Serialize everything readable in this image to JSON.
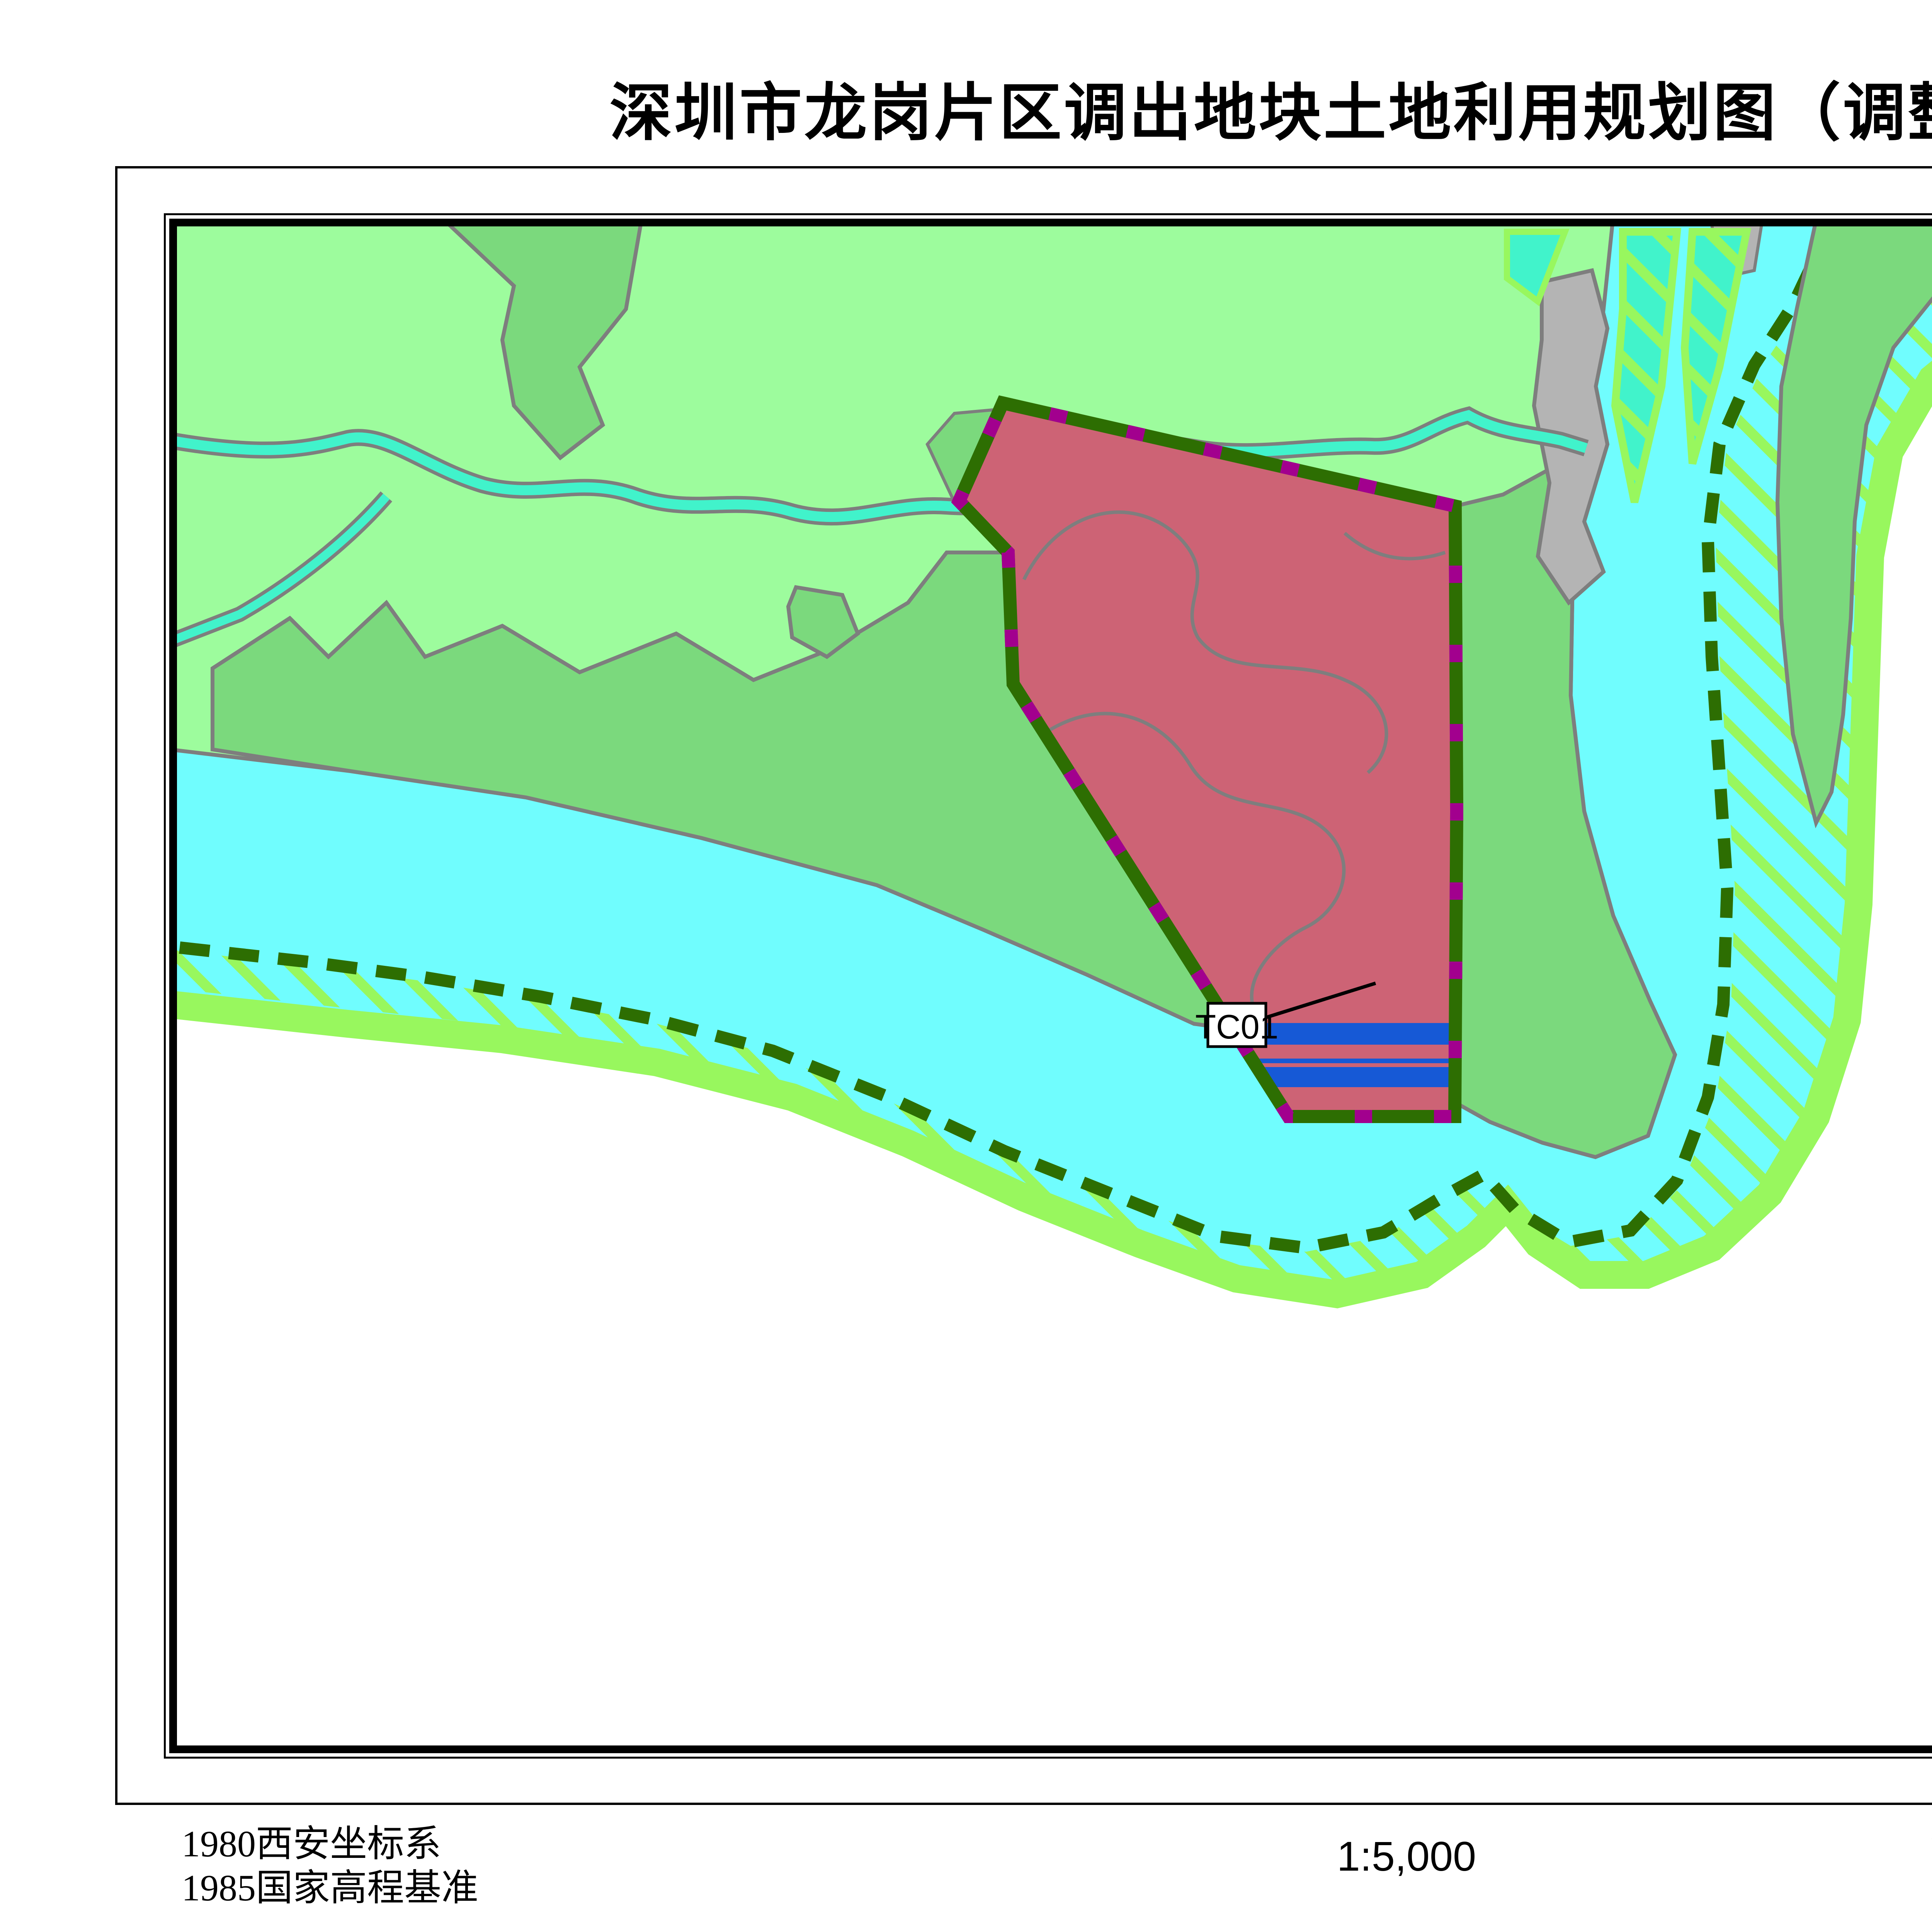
{
  "title": "深圳市龙岗片区调出地块土地利用规划图（调整前）",
  "north_label": "N",
  "map": {
    "plot_label": "TC01",
    "colors": {
      "water": "#70fdfe",
      "river": "#41f3cb",
      "orchard": "#9dfc9d",
      "forest": "#7bd97d",
      "urban": "#cd6375",
      "shore_band": "#98f75e",
      "forbidden_line": "#2d6e02",
      "allowed_line": "#a2008e",
      "plot_blue": "#1659d6",
      "reserved_gray": "#b4b4b4",
      "outline_gray": "#7e7e7e"
    }
  },
  "legend": {
    "title": "图例",
    "items": [
      {
        "label": "调出地块",
        "swatch": "outline",
        "color": "#1456d8"
      },
      {
        "label": "允许建设区",
        "swatch": "outline",
        "color": "#a3009b"
      },
      {
        "label": "有条件建设区",
        "swatch": "hatch-outline",
        "color": "#a3009b",
        "hatch": "#dd6666"
      },
      {
        "label": "禁止建设区",
        "swatch": "dashed-outline",
        "color": "#2f7009"
      },
      {
        "label": "限制建设区",
        "swatch": "hatch-outline",
        "color": "#98f75e",
        "hatch": "#98f75e"
      },
      {
        "label": "基本农田保护区",
        "swatch": "outline-fill",
        "color": "#88a903",
        "fill": "#f7f73d"
      },
      {
        "label": "耕地",
        "swatch": "fill",
        "fill": "#eff59b"
      },
      {
        "label": "园地",
        "swatch": "fill",
        "fill": "#9dfc9d"
      },
      {
        "label": "林地",
        "swatch": "fill",
        "fill": "#74d678"
      },
      {
        "label": "其他农用地",
        "swatch": "fill",
        "fill": "#41f3cb"
      },
      {
        "label": "城乡建设用地",
        "swatch": "fill",
        "fill": "#c5607a"
      },
      {
        "label": "交通水利用地",
        "swatch": "fill",
        "fill": "#f79437"
      },
      {
        "label": "其他建设用地",
        "swatch": "fill",
        "fill": "#d2671e"
      },
      {
        "label": "水域",
        "swatch": "fill",
        "fill": "#70fdfe"
      },
      {
        "label": "自然保留地",
        "swatch": "fill",
        "fill": "#b4b4b4"
      }
    ]
  },
  "footer": {
    "left_line1": "1980西安坐标系",
    "left_line2": "1985国家高程基准",
    "scale": "1:5,000",
    "right_line1": "深圳市规划和国土资源委员会滨海管理局",
    "right_line2": "二零一五年十一月"
  }
}
